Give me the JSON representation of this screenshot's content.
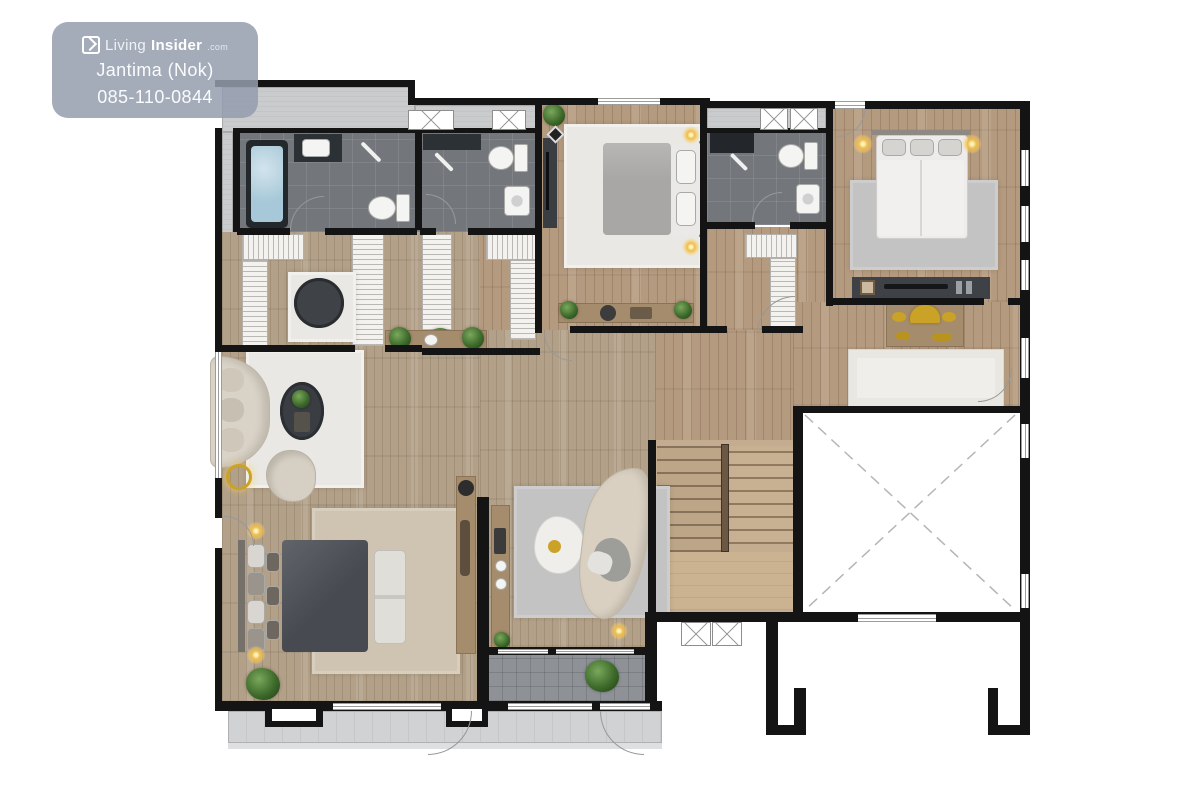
{
  "watermark": {
    "brand_light": "Living",
    "brand_bold": "Insider",
    "brand_suffix": ".com",
    "agent": "Jantima (Nok)",
    "phone": "085-110-0844"
  },
  "palette": {
    "wall": "#141414",
    "wood_floor": "#b49a7e",
    "wood_floor_light": "#b2a088",
    "concrete": "#c9cbcc",
    "bath_tile": "#73777c",
    "terrace_tile": "#8e9297",
    "rug_white": "#e9e8e4",
    "rug_beige": "#cfc4b2",
    "rug_gray": "#c2c3c2",
    "bed_dark": "#474b51",
    "bed_gray": "#a8a7a5",
    "bed_white": "#edecea",
    "tub_water": "#a6c8d8",
    "gold_accent": "#c9a227",
    "plant_green": "#3e6b2b",
    "badge_background": "#949daf"
  }
}
